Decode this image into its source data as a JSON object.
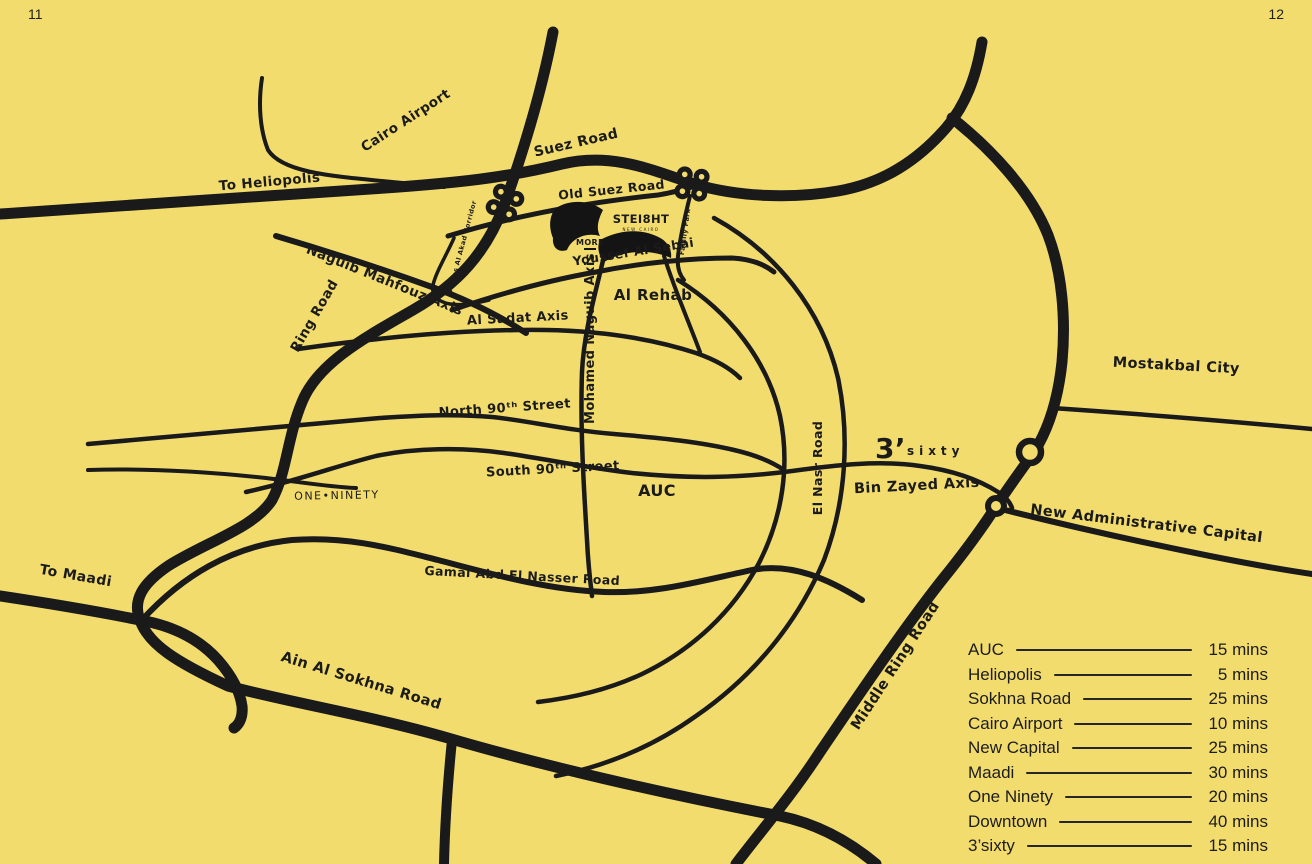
{
  "page": {
    "left_number": "11",
    "right_number": "12"
  },
  "colors": {
    "background": "#F3DC6E",
    "road": "#1A1A1A",
    "text": "#1B1B1B"
  },
  "map": {
    "labels": {
      "cairo_airport": "Cairo Airport",
      "to_heliopolis": "To Heliopolis",
      "suez_road": "Suez Road",
      "old_suez_road": "Old Suez Road",
      "ring_road": "Ring Road",
      "naguib_mahfouz_axis": "Naguib Mahfouz Axis",
      "abbas_al_akad_corridor": "Abbas Al Akad Corridor",
      "youssef_al_sebai": "Youssef Al Sebai",
      "family_park": "Family Park",
      "al_rehab": "Al Rehab",
      "al_sadat_axis": "Al Sadat Axis",
      "mohamed_naguib_axis": "Mohamed Naguib Axis",
      "north_90th_street": "North 90ᵗʰ Street",
      "south_90th_street": "South 90ᵗʰ Street",
      "one_ninety": "ONE•NINETY",
      "auc": "AUC",
      "el_nasr_road": "El Nasr Road",
      "bin_zayed_axis": "Bin Zayed Axis",
      "mostakbal_city": "Mostakbal City",
      "new_administrative_capital": "New Administrative Capital",
      "to_maadi": "To Maadi",
      "gamal_abd_el_nasser_road": "Gamal Abd El Nasser Road",
      "ain_al_sokhna_road": "Ain Al Sokhna Road",
      "middle_ring_road": "Middle Ring Road"
    },
    "site": {
      "name": "STEI8HT",
      "subtext": "NEW CAIRO",
      "neighbor": "MORE"
    },
    "logo_3sixty": {
      "prefix": "3’",
      "rest": "s i x t y"
    }
  },
  "legend": {
    "items": [
      {
        "place": "AUC",
        "time": "15 mins"
      },
      {
        "place": "Heliopolis",
        "time": "5 mins"
      },
      {
        "place": "Sokhna Road",
        "time": "25 mins"
      },
      {
        "place": "Cairo Airport",
        "time": "10 mins"
      },
      {
        "place": "New Capital",
        "time": "25 mins"
      },
      {
        "place": "Maadi",
        "time": "30 mins"
      },
      {
        "place": "One Ninety",
        "time": "20 mins"
      },
      {
        "place": "Downtown",
        "time": "40 mins"
      },
      {
        "place": "3’sixty",
        "time": "15 mins"
      }
    ]
  }
}
